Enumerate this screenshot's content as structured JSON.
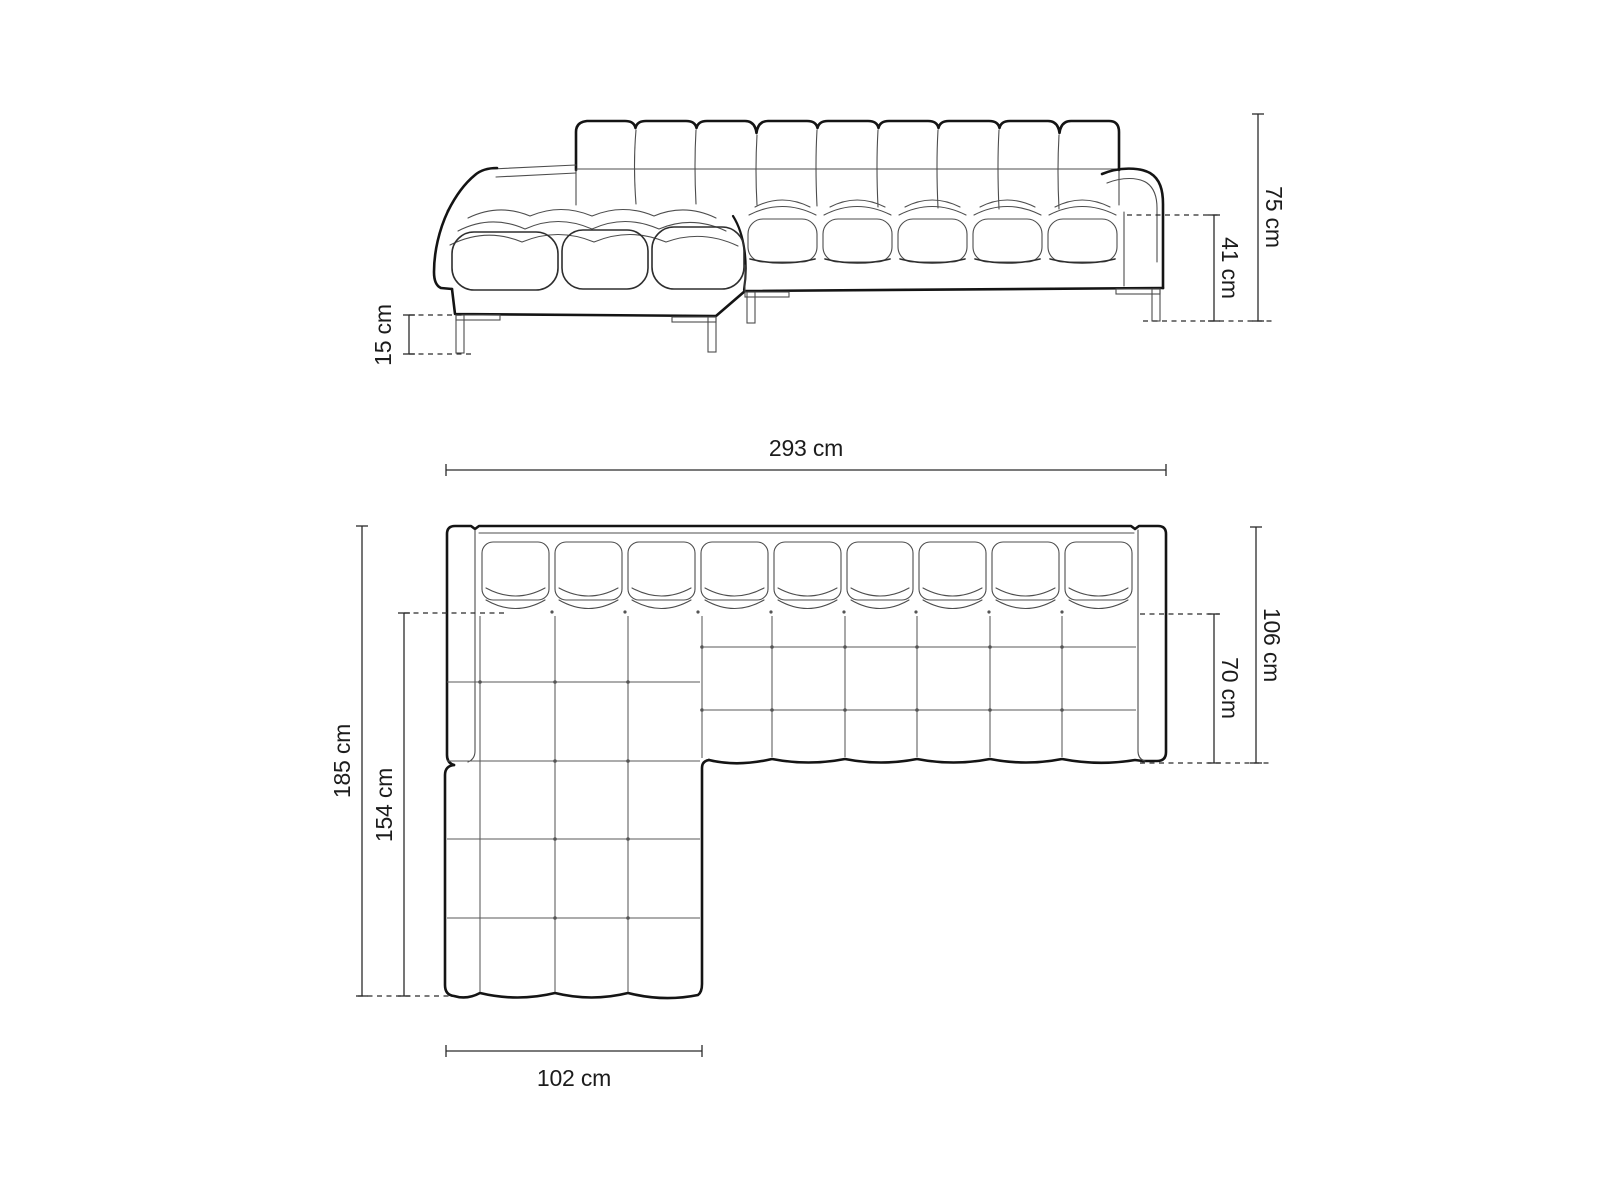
{
  "diagram": {
    "subject": "corner-sofa-dimension-drawing",
    "unit": "cm",
    "colors": {
      "background": "#ffffff",
      "outline": "#141414",
      "inner_line": "#4d4d4d",
      "dimension_line": "#2b2b2b",
      "label_text": "#1c1c1c"
    },
    "front_view": {
      "name": "front elevation",
      "dimensions": [
        {
          "id": "total-height",
          "value": 75,
          "label": "75 cm"
        },
        {
          "id": "seat-height",
          "value": 41,
          "label": "41 cm"
        },
        {
          "id": "leg-height",
          "value": 15,
          "label": "15 cm"
        }
      ]
    },
    "plan_view": {
      "name": "top plan",
      "dimensions": [
        {
          "id": "total-width",
          "value": 293,
          "label": "293 cm"
        },
        {
          "id": "total-depth",
          "value": 185,
          "label": "185 cm"
        },
        {
          "id": "chaise-depth",
          "value": 154,
          "label": "154 cm"
        },
        {
          "id": "body-depth",
          "value": 106,
          "label": "106 cm"
        },
        {
          "id": "seat-depth",
          "value": 70,
          "label": "70 cm"
        },
        {
          "id": "chaise-width",
          "value": 102,
          "label": "102 cm"
        }
      ]
    }
  }
}
